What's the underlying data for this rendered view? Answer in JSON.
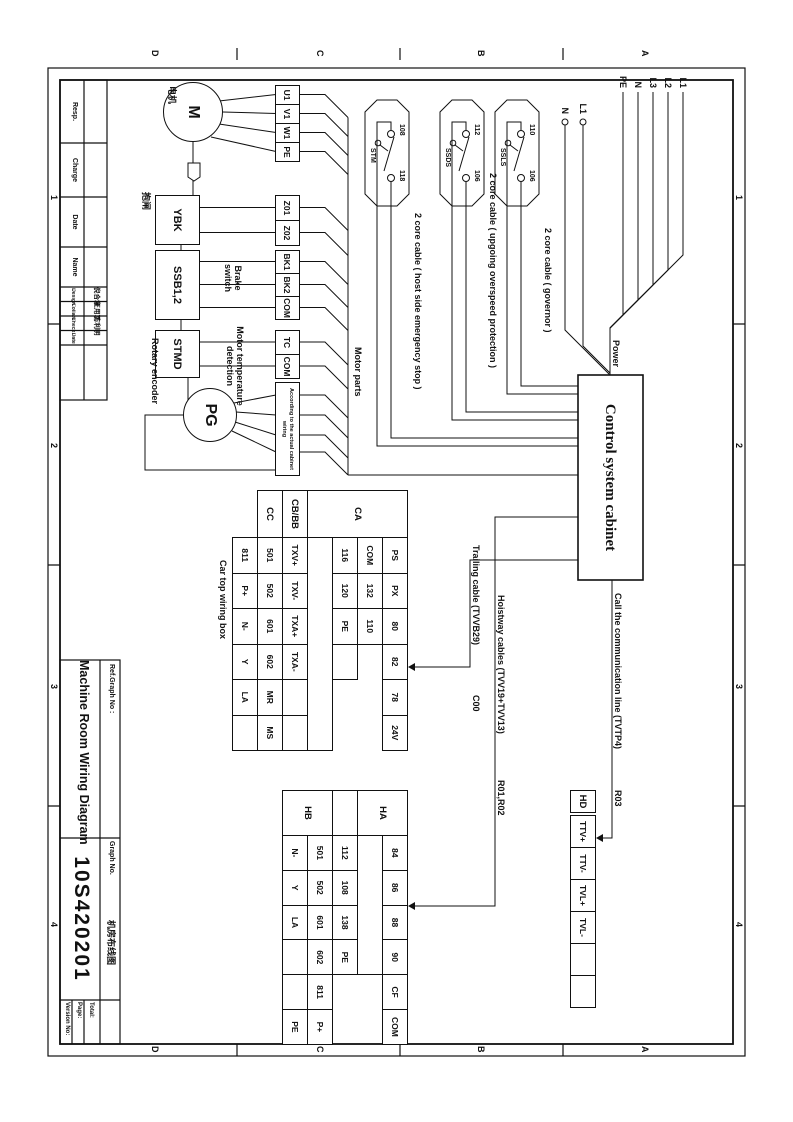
{
  "sheet": {
    "zone_letters": [
      "A",
      "B",
      "C",
      "D"
    ],
    "zone_numbers": [
      "1",
      "2",
      "3",
      "4"
    ]
  },
  "title_block": {
    "ref_graph_no_label": "Ref.Graph No :",
    "drawing_title_en": "Machine Room Wiring Diagram",
    "graph_no_label": "Graph No.",
    "graph_no": "10S420201",
    "drawing_title_cn": "机房布线图",
    "version_label": "Version No:",
    "page_label": "Page:",
    "total_label": "Total:",
    "resp_label": "Resp.",
    "charge_label": "Charge",
    "date_label": "Date",
    "name_label": "Name",
    "sign_columns": [
      {
        "role": "Design",
        "name": "倪合章"
      },
      {
        "role": "Collate",
        "name": "王用军"
      },
      {
        "role": "Check",
        "name": "方利明"
      },
      {
        "role": "Date",
        "name": ""
      }
    ]
  },
  "power": {
    "lines": [
      "L1",
      "L2",
      "L3",
      "N",
      "PE"
    ],
    "aux_lines": [
      "L1",
      "N"
    ],
    "label": "Power"
  },
  "cabinet": {
    "label": "Control system cabinet"
  },
  "switches": [
    {
      "name": "SSLS",
      "t1": "110",
      "t2": "106",
      "cable": "2 core cable ( governor )"
    },
    {
      "name": "SSDS",
      "t1": "112",
      "t2": "106",
      "cable": "2 core cable ( upgoing overspeed protection )"
    },
    {
      "name": "STM",
      "t1": "108",
      "t2": "118",
      "cable": "2 core cable ( host side emergency stop )"
    }
  ],
  "motor_group": {
    "motor": "M",
    "motor_cn": "电机",
    "brake": "YBK",
    "brake_cn": "抱闸",
    "brake_switch": "SSB1,2",
    "brake_switch_label": "Brake switch",
    "temp": "STMD",
    "temp_label": "Motor temperature detection",
    "encoder": "PG",
    "encoder_label": "Rotary encoder",
    "encoder_box_note": "According to the actual cabinet wiring",
    "motor_parts_label": "Motor parts",
    "terminals_motor": [
      "U1",
      "V1",
      "W1",
      "PE"
    ],
    "terminals_brake": [
      "Z01",
      "Z02"
    ],
    "terminals_brake_switch": [
      "BK1",
      "BK2",
      "COM"
    ],
    "terminals_temp": [
      "TC",
      "COM"
    ]
  },
  "cables": {
    "trailing": "Trailing cable (TVVB29)",
    "trailing_ref": "C00",
    "hoistway": "Hoistway cables (TVV19+TVV13)",
    "hoistway_ref": "R01,R02",
    "comm": "Call the communication line (TVTP4)",
    "comm_ref": "R03"
  },
  "car_top_table": {
    "caption": "Car top wiring box",
    "headers": [
      {
        "label": "CA",
        "rowspan": 4
      },
      {
        "label": "CB/BB",
        "rowspan": 1
      },
      {
        "label": "CC",
        "rowspan": 1
      }
    ],
    "rows": [
      [
        "PS",
        "PX",
        "80",
        "82",
        "78",
        "24V"
      ],
      [
        "COM",
        "132",
        "110"
      ],
      [
        "116",
        "120",
        "PE",
        ""
      ],
      [],
      [
        "TXV+",
        "TXV-",
        "TXA+",
        "TXA-",
        "",
        ""
      ],
      [
        "501",
        "502",
        "601",
        "602",
        "MR",
        "MS"
      ],
      [
        "811",
        "P+",
        "N-",
        "Y",
        "LA",
        ""
      ]
    ]
  },
  "hall_table": {
    "headers": [
      {
        "label": "HA",
        "rowspan": 2
      },
      {
        "label": "",
        "rowspan": 1
      },
      {
        "label": "HB",
        "rowspan": 2
      }
    ],
    "rows": [
      [
        "84",
        "86",
        "88",
        "90",
        "CF",
        "COM"
      ],
      [],
      [
        "112",
        "108",
        "138",
        "PE"
      ],
      [
        "501",
        "502",
        "601",
        "602",
        "811",
        "P+"
      ],
      [
        "N-",
        "Y",
        "LA",
        "",
        "",
        "PE"
      ]
    ]
  },
  "hd_strip": {
    "label": "HD",
    "cells": [
      "TTV+",
      "TTV-",
      "TVL+",
      "TVL-",
      "",
      ""
    ]
  }
}
